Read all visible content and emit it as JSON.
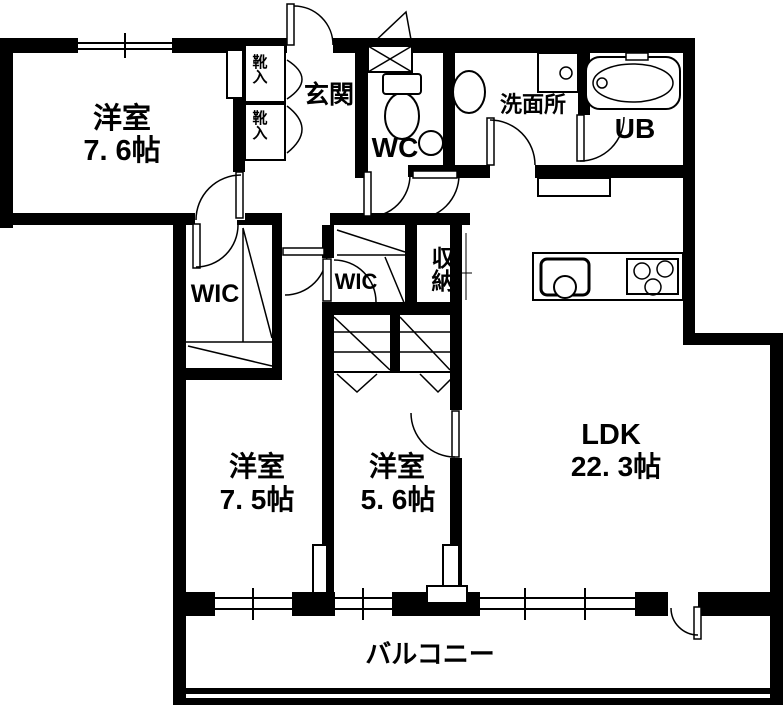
{
  "rooms": {
    "bedroom1": {
      "name": "洋室",
      "size": "7. 6帖"
    },
    "bedroom2": {
      "name": "洋室",
      "size": "7. 5帖"
    },
    "bedroom3": {
      "name": "洋室",
      "size": "5. 6帖"
    },
    "ldk": {
      "name": "LDK",
      "size": "22. 3帖"
    },
    "entrance": {
      "label": "玄関"
    },
    "wc": {
      "label": "WC"
    },
    "washroom": {
      "label": "洗面所"
    },
    "bath": {
      "label": "UB"
    },
    "wic1": {
      "label": "WIC"
    },
    "wic2": {
      "label": "WIC"
    },
    "storage": {
      "label": "収納"
    },
    "shoe_cabinet1": {
      "label": "靴入"
    },
    "shoe_cabinet2": {
      "label": "靴入"
    },
    "balcony": {
      "label": "バルコニー"
    }
  },
  "colors": {
    "wall": "#000000",
    "background": "#ffffff",
    "line": "#000000"
  }
}
